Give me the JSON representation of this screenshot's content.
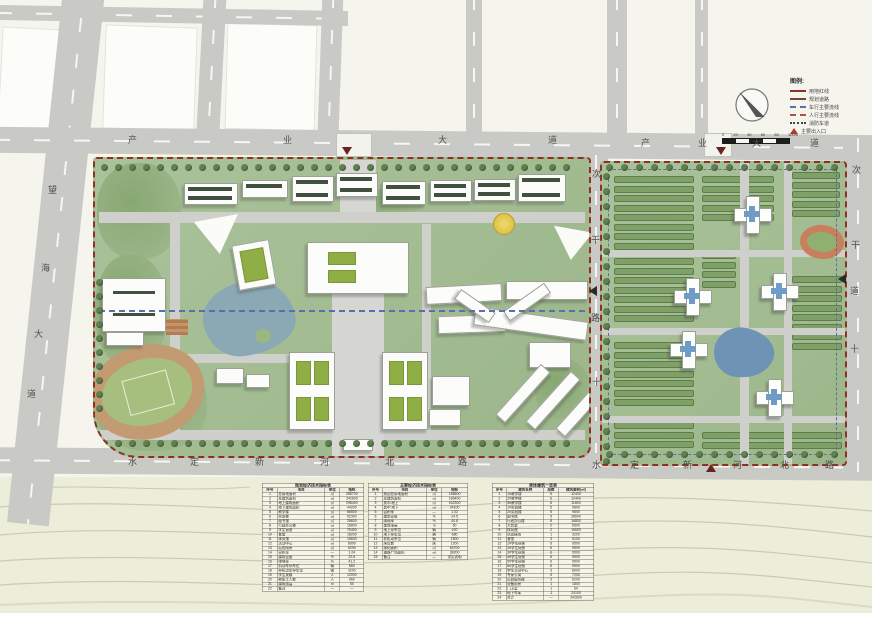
{
  "roads": {
    "top_west": "产业大道",
    "top_east": "产业大道",
    "left": "望海大道",
    "bottom_west": "水定新河北路",
    "bottom_east": "水定新河北路",
    "middle": "次干路十",
    "right": "次干道十"
  },
  "legend": {
    "title": "图例:",
    "items": [
      {
        "kind": "solid-red",
        "label": "用地红线"
      },
      {
        "kind": "solid-maroon",
        "label": "规划道路"
      },
      {
        "kind": "dash-blue",
        "label": "车行主要流线"
      },
      {
        "kind": "dash-red",
        "label": "人行主要流线"
      },
      {
        "kind": "dot-black",
        "label": "消防车道"
      },
      {
        "kind": "triangle",
        "label": "主要出入口"
      }
    ]
  },
  "scalebar": {
    "labels": [
      "0",
      "20",
      "40",
      "60",
      "80",
      "100m"
    ]
  },
  "colors": {
    "boundary_red": "#8e3026",
    "flow_blue": "#5a6fae",
    "road_gray": "#c9c9c6",
    "campus_green": "#a3bc90",
    "water_blue": "#8ba8b5"
  },
  "tables": [
    {
      "title": "规划经济技术指标表",
      "headers": [
        "序号",
        "项目",
        "单位",
        "指标"
      ],
      "rows": [
        [
          "1",
          "总用地面积",
          "㎡",
          "286700"
        ],
        [
          "2",
          "总建筑面积",
          "㎡",
          "342600"
        ],
        [
          "3",
          "地上建筑面积",
          "㎡",
          "298400"
        ],
        [
          "4",
          "地下建筑面积",
          "㎡",
          "44200"
        ],
        [
          "5",
          "教学楼",
          "㎡",
          "86500"
        ],
        [
          "6",
          "实验楼",
          "㎡",
          "52300"
        ],
        [
          "7",
          "图书馆",
          "㎡",
          "28600"
        ],
        [
          "8",
          "行政办公楼",
          "㎡",
          "16800"
        ],
        [
          "9",
          "学生宿舍",
          "㎡",
          "75400"
        ],
        [
          "10",
          "食堂",
          "㎡",
          "18200"
        ],
        [
          "11",
          "体育馆",
          "㎡",
          "15600"
        ],
        [
          "12",
          "活动中心",
          "㎡",
          "8900"
        ],
        [
          "13",
          "后勤用房",
          "㎡",
          "6200"
        ],
        [
          "14",
          "容积率",
          "—",
          "1.04"
        ],
        [
          "15",
          "建筑密度",
          "%",
          "22.6"
        ],
        [
          "16",
          "绿地率",
          "%",
          "41.2"
        ],
        [
          "17",
          "机动车停车位",
          "辆",
          "860"
        ],
        [
          "18",
          "非机动车停车位",
          "辆",
          "3200"
        ],
        [
          "19",
          "学生规模",
          "人",
          "12000"
        ],
        [
          "20",
          "教职工人数",
          "人",
          "960"
        ],
        [
          "21",
          "建筑限高",
          "m",
          "50"
        ],
        [
          "22",
          "备注",
          "—",
          "—"
        ]
      ]
    },
    {
      "title": "主要经济技术指标表",
      "headers": [
        "序号",
        "项目",
        "单位",
        "指标"
      ],
      "rows": [
        [
          "1",
          "规划总用地面积",
          "㎡",
          "158600"
        ],
        [
          "2",
          "总建筑面积",
          "㎡",
          "186400"
        ],
        [
          "3",
          "其中:地上",
          "㎡",
          "162300"
        ],
        [
          "4",
          "其中:地下",
          "㎡",
          "24100"
        ],
        [
          "5",
          "容积率",
          "—",
          "1.02"
        ],
        [
          "6",
          "建筑密度",
          "%",
          "24.5"
        ],
        [
          "7",
          "绿地率",
          "%",
          "40.8"
        ],
        [
          "8",
          "建筑限高",
          "m",
          "50"
        ],
        [
          "9",
          "地上停车位",
          "辆",
          "420"
        ],
        [
          "10",
          "地下停车位",
          "辆",
          "680"
        ],
        [
          "11",
          "非机动车位",
          "辆",
          "1500"
        ],
        [
          "12",
          "床位数",
          "床",
          "1200"
        ],
        [
          "13",
          "绿化面积",
          "㎡",
          "64700"
        ],
        [
          "14",
          "道路广场面积",
          "㎡",
          "38200"
        ],
        [
          "15",
          "备注",
          "—",
          "详见说明"
        ]
      ]
    },
    {
      "title": "单体建筑一览表",
      "headers": [
        "序号",
        "建筑名称",
        "层数",
        "建筑面积(㎡)"
      ],
      "rows": [
        [
          "1",
          "1#教学楼",
          "6",
          "12400"
        ],
        [
          "2",
          "2#教学楼",
          "6",
          "12400"
        ],
        [
          "3",
          "3#教学楼",
          "6",
          "11800"
        ],
        [
          "4",
          "1#实验楼",
          "5",
          "9800"
        ],
        [
          "5",
          "2#实验楼",
          "5",
          "9800"
        ],
        [
          "6",
          "图书馆",
          "5",
          "28600"
        ],
        [
          "7",
          "行政办公楼",
          "8",
          "16800"
        ],
        [
          "8",
          "大会堂",
          "2",
          "6500"
        ],
        [
          "9",
          "体育馆",
          "2",
          "15600"
        ],
        [
          "10",
          "风雨操场",
          "1",
          "3200"
        ],
        [
          "11",
          "食堂",
          "3",
          "9100"
        ],
        [
          "12",
          "1#学生宿舍",
          "6",
          "9500"
        ],
        [
          "13",
          "2#学生宿舍",
          "6",
          "9500"
        ],
        [
          "14",
          "3#学生宿舍",
          "6",
          "9500"
        ],
        [
          "15",
          "4#学生宿舍",
          "6",
          "9500"
        ],
        [
          "16",
          "5#学生宿舍",
          "6",
          "9500"
        ],
        [
          "17",
          "6#学生宿舍",
          "6",
          "9500"
        ],
        [
          "18",
          "学生活动中心",
          "3",
          "8900"
        ],
        [
          "19",
          "专家公寓",
          "5",
          "7200"
        ],
        [
          "20",
          "后勤服务楼",
          "3",
          "6200"
        ],
        [
          "21",
          "设备用房",
          "1",
          "1800"
        ],
        [
          "22",
          "门卫室",
          "1",
          "60"
        ],
        [
          "23",
          "地下车库",
          "-1",
          "24100"
        ],
        [
          "24",
          "合计",
          "—",
          "342600"
        ]
      ]
    }
  ]
}
